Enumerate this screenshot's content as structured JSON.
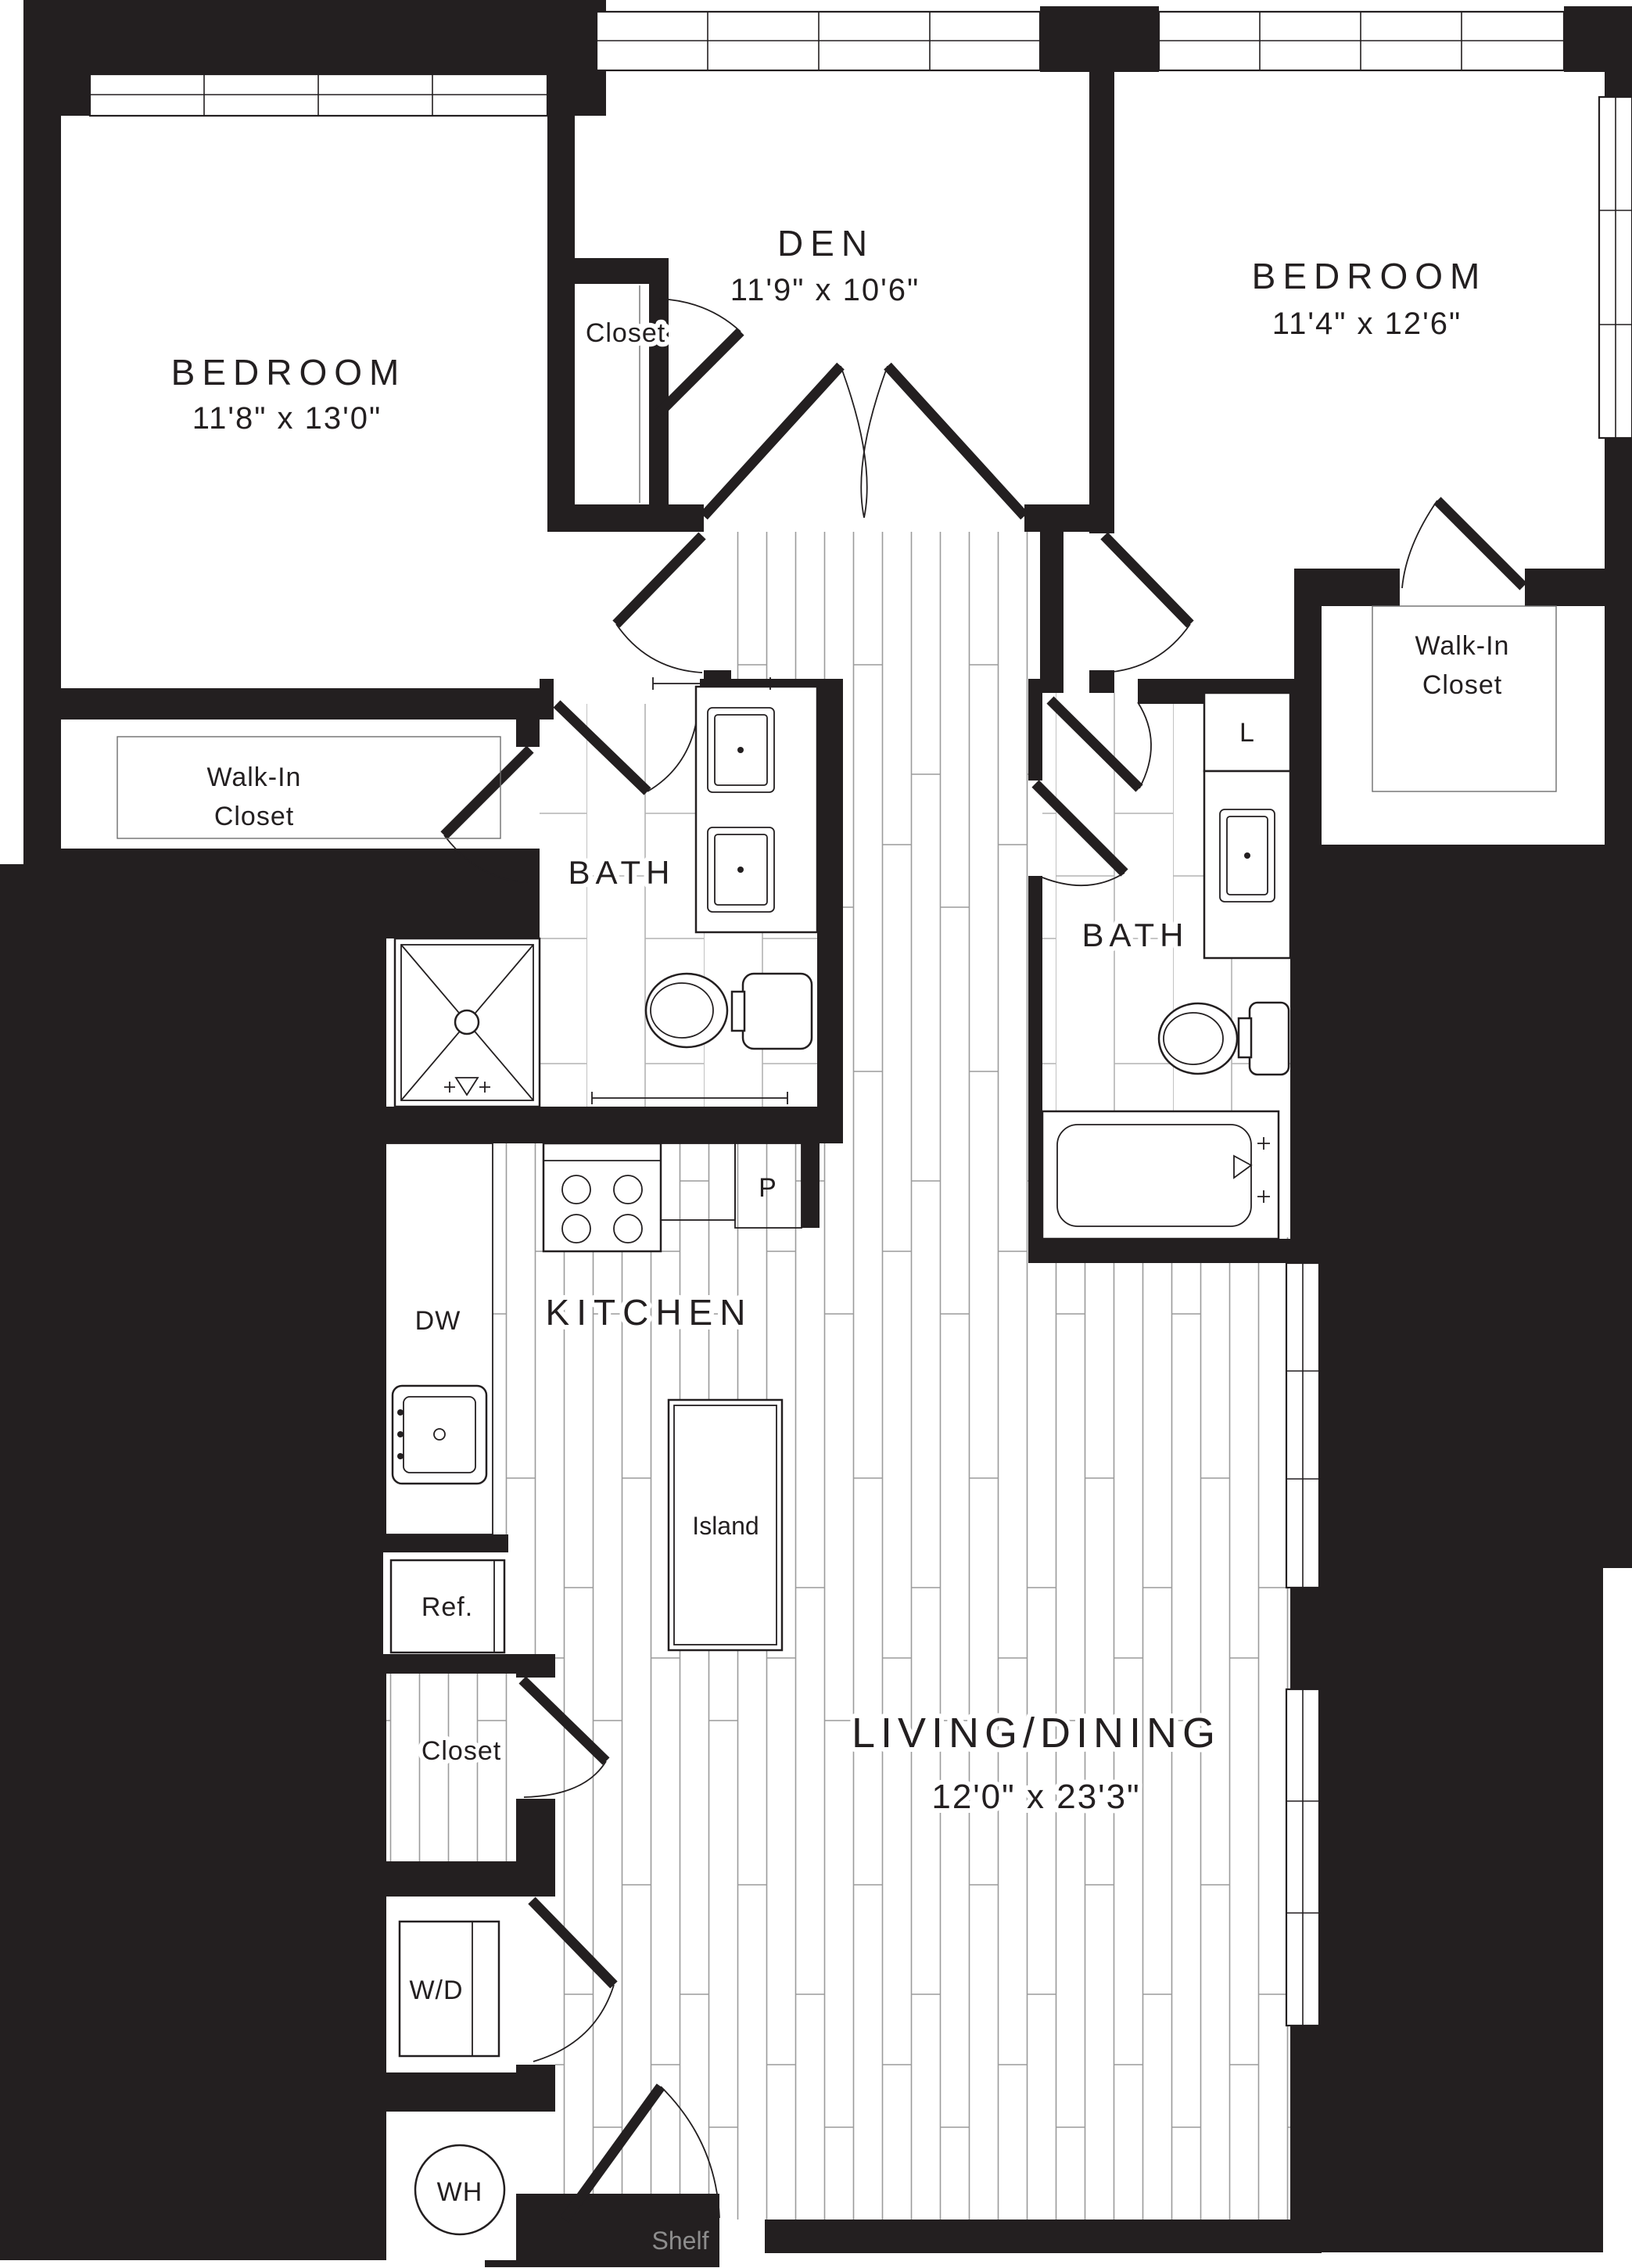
{
  "plan": {
    "title": "Apartment floor plan - 2 bed / den / 2 bath",
    "rooms": {
      "bedroom_left": {
        "name": "BEDROOM",
        "dims": "11'8\" x 13'0\""
      },
      "den": {
        "name": "DEN",
        "dims": "11'9\" x 10'6\""
      },
      "bedroom_right": {
        "name": "BEDROOM",
        "dims": "11'4\" x 12'6\""
      },
      "living_dining": {
        "name": "LIVING/DINING",
        "dims": "12'0\" x 23'3\""
      },
      "kitchen": {
        "name": "KITCHEN"
      },
      "bath_left": {
        "name": "BATH"
      },
      "bath_right": {
        "name": "BATH"
      },
      "walk_in_closet_left": {
        "line1": "Walk-In",
        "line2": "Closet"
      },
      "walk_in_closet_right": {
        "line1": "Walk-In",
        "line2": "Closet"
      }
    },
    "labels": {
      "den_closet": "Closet",
      "hall_closet": "Closet",
      "dishwasher": "DW",
      "pantry": "P",
      "island": "Island",
      "refrigerator": "Ref.",
      "washer_dryer": "W/D",
      "water_heater": "WH",
      "linen": "L",
      "shelf": "Shelf"
    },
    "colors": {
      "wall": "#231f20",
      "plank_line": "#9b9b9b",
      "tile_line": "#b3b3b3",
      "shelf_text": "#8d8d8d",
      "background": "#ffffff"
    }
  }
}
